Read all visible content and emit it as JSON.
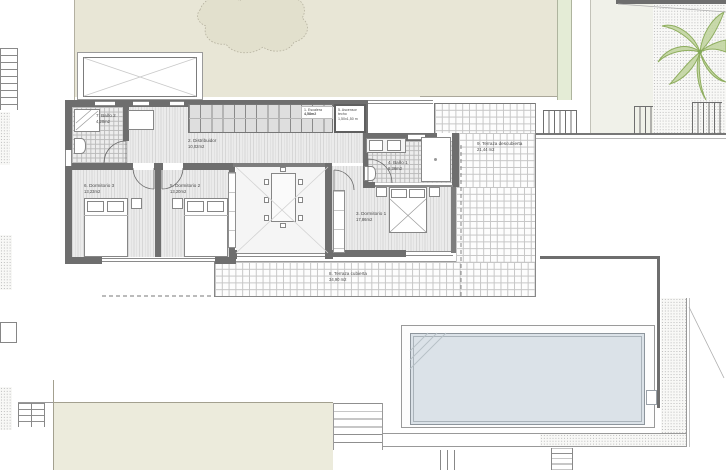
{
  "plan_title": "Villa floor plan – first floor",
  "labels": {
    "escalera": {
      "l1": "1. Escalera",
      "l2": "4,58m2"
    },
    "distribuidor": {
      "l1": "2. Distribuidor",
      "l2": "10,02m2"
    },
    "dormitorio1": {
      "l1": "3. Dormitorio 1",
      "l2": "17,86m2"
    },
    "bano1": {
      "l1": "4. Baño 1",
      "l2": "6,36m2"
    },
    "dormitorio2": {
      "l1": "5. Dormitorio 2",
      "l2": "13,20m2"
    },
    "dormitorio3": {
      "l1": "6. Dormitorio 3",
      "l2": "13,23m2"
    },
    "bano2": {
      "l1": "7. Baño 2",
      "l2": "4,20m2"
    },
    "terraza_cubierta": {
      "l1": "8. Terraza cubierta",
      "l2": "34,90 m2"
    },
    "terraza_descubierta": {
      "l1": "9. Terraza descubierta",
      "l2": "21,44 m2"
    },
    "ascensor": {
      "l1": "5. Ascensor",
      "l2": "techo",
      "l3": "1,50x1,50 m"
    }
  },
  "colors": {
    "wall": "#6e6e6e",
    "garden": "#e8e6d6",
    "tree": "#e2e0cd",
    "deck": "#ecebdc",
    "pool_water": "#dbe2e8",
    "palm_green": "#a9c57d"
  }
}
